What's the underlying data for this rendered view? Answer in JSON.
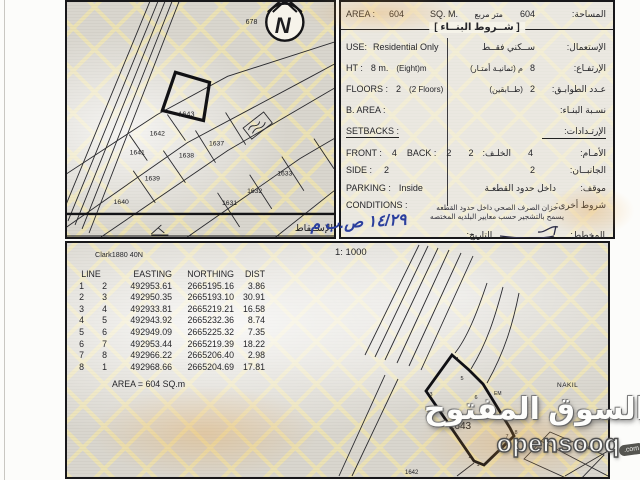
{
  "info_panel": {
    "area_label_en": "AREA :",
    "area_value_en": "604",
    "area_unit_en": "SQ. M.",
    "area_unit_ar": "متر مربع",
    "area_value_ar": "604",
    "area_label_ar": "المساحة:",
    "header_ar": "[ شــروط البنــاء ]",
    "use_label_en": "USE:",
    "use_value_en": "Residential Only",
    "use_value_ar": "ســكني فقــط",
    "use_label_ar": "الإستعمال:",
    "ht_label_en": "HT :",
    "ht_value_en": "8 m.",
    "ht_note_en": "(Eight)m",
    "ht_note_ar": "م (ثمانيـة أمتـار)",
    "ht_value_ar": "8",
    "ht_label_ar": "الإرتفـاع:",
    "floors_label_en": "FLOORS :",
    "floors_value_en": "2",
    "floors_note_en": "(2 Floors)",
    "floors_note_ar": "(طــابقين)",
    "floors_value_ar": "2",
    "floors_label_ar": "عـدد الطوابـق:",
    "barea_label_en": "B. AREA :",
    "barea_label_ar": "نسـبة البنـاء:",
    "setbacks_label_en": "SETBACKS :",
    "setbacks_label_ar": "الإرتـدادات:",
    "front_label_en": "FRONT :",
    "front_value_en": "4",
    "back_label_en": "BACK :",
    "back_value_en": "2",
    "front_label_ar": "الأمـام:",
    "front_value_ar": "4",
    "back_label_ar": "الخلـف:",
    "back_value_ar": "2",
    "side_label_en": "SIDE :",
    "side_value_en": "2",
    "side_label_ar": "الجانبــان:",
    "side_value_ar": "2",
    "parking_label_en": "PARKING :",
    "parking_value_en": "Inside",
    "parking_label_ar": "موقف:",
    "parking_value_ar": "داخل حدود القطعـة",
    "conditions_label_en": "CONDITIONS :",
    "conditions_label_ar": "شروط أخرى:",
    "note_line1": "خزان الصرف الصحي داخل حدود القطعه",
    "note_line2": "يسمح بالتشجير حسب معايير البلديه المختصه",
    "planner_label_ar": "المخطط:",
    "date_label_ar": "التاريخ:",
    "date_value_hand": "١٤/٢٩ ص.ب م"
  },
  "top_map": {
    "north_letter": "N",
    "block_number": "678",
    "plots": [
      "1643",
      "1642",
      "1637",
      "1641",
      "1638",
      "1639",
      "1640",
      "1631",
      "1632",
      "1633"
    ],
    "highlighted_plot": "1643",
    "footer_label_ar": "الإســقاط"
  },
  "bottom_section": {
    "scale": "1: 1000",
    "datum": "Clark1880 40N",
    "table": {
      "headers": [
        "LINE",
        "EASTING",
        "NORTHING",
        "DIST"
      ],
      "rows": [
        [
          "1",
          "2",
          "492953.61",
          "2665195.16",
          "3.86"
        ],
        [
          "2",
          "3",
          "492950.35",
          "2665193.10",
          "30.91"
        ],
        [
          "3",
          "4",
          "492933.81",
          "2665219.21",
          "16.58"
        ],
        [
          "4",
          "5",
          "492943.92",
          "2665232.36",
          "8.74"
        ],
        [
          "5",
          "6",
          "492949.09",
          "2665225.32",
          "7.35"
        ],
        [
          "6",
          "7",
          "492953.44",
          "2665219.39",
          "18.22"
        ],
        [
          "7",
          "8",
          "492966.22",
          "2665206.40",
          "2.98"
        ],
        [
          "8",
          "1",
          "492968.66",
          "2665204.69",
          "17.81"
        ]
      ],
      "area_line": "AREA = 604  SQ.m"
    },
    "map": {
      "plot_number": "1643",
      "neighbor_plot": "1642",
      "label_em": "EM",
      "label_em2": "E.M",
      "label_nakil": "NAKIL",
      "vertices": [
        "1",
        "2",
        "3",
        "4",
        "5",
        "6",
        "7",
        "8"
      ]
    }
  },
  "watermark": {
    "ar": "السوق المفتوح",
    "en": "opensooq",
    "tld": ".com"
  },
  "colors": {
    "ink": "#1c1c1c",
    "pattern_line": "#ece2b4",
    "pattern_base": "#d9d6ce",
    "handwriting_blue": "#2b3f9d",
    "watermark_outline": "#4f4f4f",
    "accent_orange": "#e8a23c"
  }
}
